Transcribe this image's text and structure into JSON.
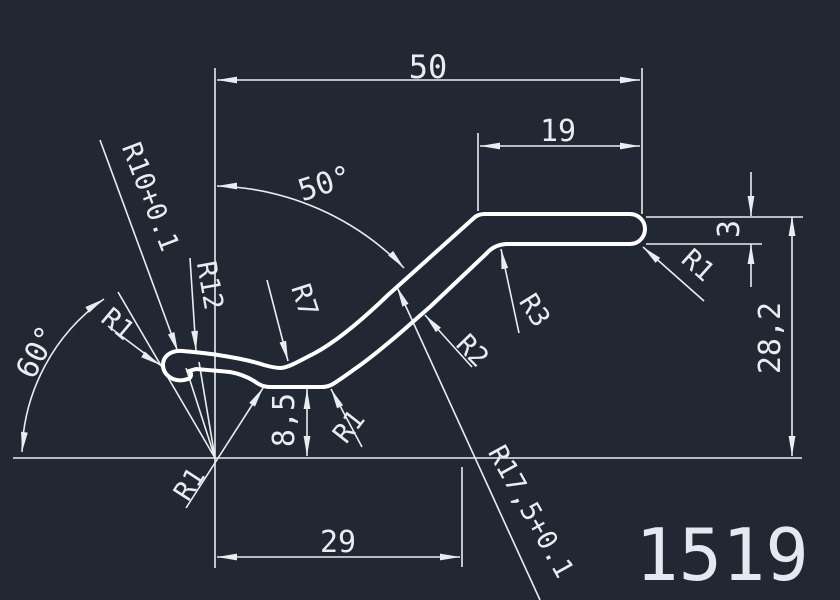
{
  "title_block": {
    "part_number": "1519"
  },
  "linear_dimensions": {
    "overall_width": "50",
    "top_flange_width": "19",
    "bottom_width": "29",
    "overall_height": "28,2",
    "valley_height": "8,5",
    "thickness": "3"
  },
  "angular_dimensions": {
    "slope_angle": "50°",
    "left_angle": "60°"
  },
  "radius_callouts": {
    "r10_curl": "R10+0.1",
    "r12_curl_outer": "R12",
    "r1_left_end": "R1",
    "r7_valley_top": "R7",
    "r1_valley_left": "R1",
    "r1_valley_right": "R1",
    "r2_slope_bend": "R2",
    "r3_top_corner": "R3",
    "r17_5_sweep": "R17,5+0.1",
    "r1_right_end": "R1"
  },
  "colors": {
    "background": "#212833",
    "dimension_lines": "#e9edf2",
    "profile_outline": "#ffffff"
  }
}
